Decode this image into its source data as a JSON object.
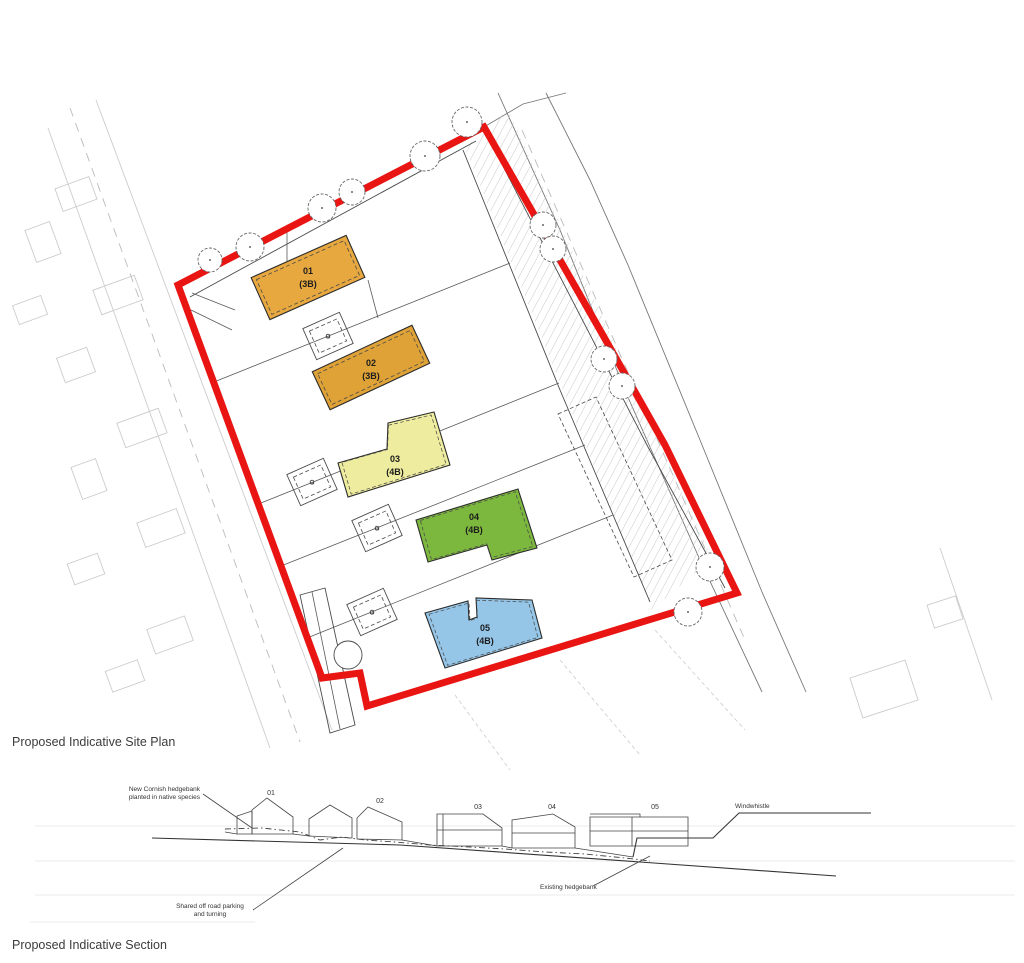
{
  "page": {
    "plan_title": "Proposed Indicative Site Plan",
    "section_title": "Proposed Indicative Section"
  },
  "site_plan": {
    "boundary_color": "#e81513",
    "garage_label": "G",
    "plots": [
      {
        "id": "01",
        "beds": "(3B)",
        "color": "#e7a83f"
      },
      {
        "id": "02",
        "beds": "(3B)",
        "color": "#dfa236"
      },
      {
        "id": "03",
        "beds": "(4B)",
        "color": "#eeec9e"
      },
      {
        "id": "04",
        "beds": "(4B)",
        "color": "#7cb73e"
      },
      {
        "id": "05",
        "beds": "(4B)",
        "color": "#95c6e8"
      }
    ]
  },
  "section": {
    "house_labels": [
      "01",
      "02",
      "03",
      "04",
      "05"
    ],
    "annotations": {
      "new_hedgebank_1": "New Cornish hedgebank",
      "new_hedgebank_2": "planted in native species",
      "parking_1": "Shared off road parking",
      "parking_2": "and turning",
      "existing_hedgebank": "Existing hedgebank",
      "road_name": "Windwhistle"
    }
  }
}
